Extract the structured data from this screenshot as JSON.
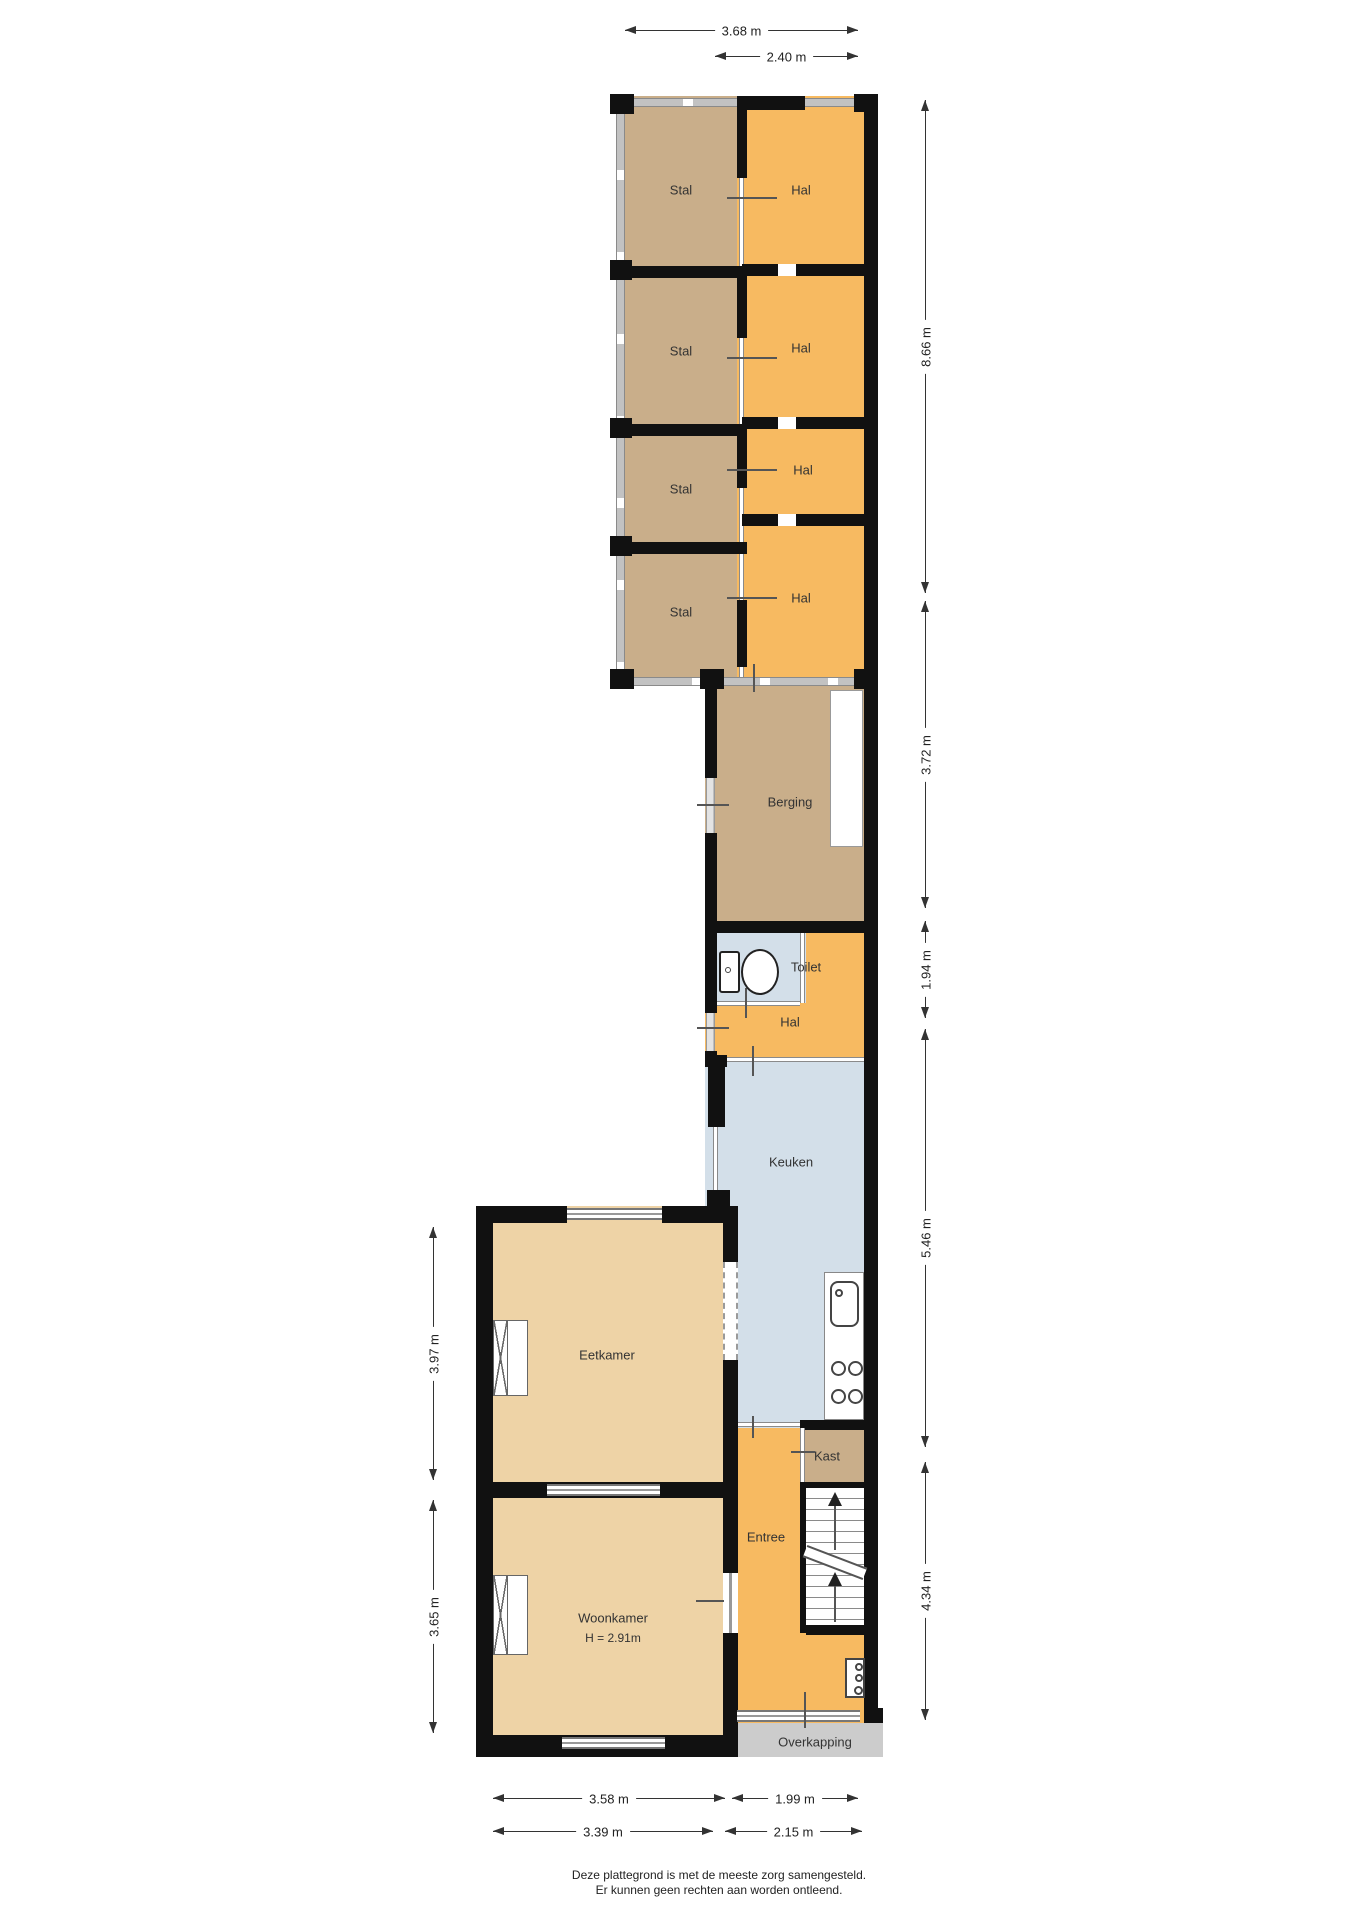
{
  "rooms": {
    "stal_1": "Stal",
    "stal_2": "Stal",
    "stal_3": "Stal",
    "stal_4": "Stal",
    "hal_1": "Hal",
    "hal_2": "Hal",
    "hal_3": "Hal",
    "hal_4": "Hal",
    "berging": "Berging",
    "toilet": "Toilet",
    "hal_middle": "Hal",
    "keuken": "Keuken",
    "eetkamer": "Eetkamer",
    "woonkamer": "Woonkamer",
    "woonkamer_ceiling_height": "H = 2.91m",
    "kast": "Kast",
    "entree": "Entree",
    "overkapping": "Overkapping"
  },
  "dimensions": {
    "top": [
      "3.68 m",
      "2.40 m"
    ],
    "right": [
      "8.66 m",
      "3.72 m",
      "1.94 m",
      "5.46 m",
      "4.34 m"
    ],
    "left": [
      "3.97 m",
      "3.65 m"
    ],
    "bottom_upper": [
      "3.58 m",
      "1.99 m"
    ],
    "bottom_lower": [
      "3.39 m",
      "2.15 m"
    ]
  },
  "footer": {
    "line1": "Deze plattegrond is met de meeste zorg samengesteld.",
    "line2": "Er kunnen geen rechten aan worden ontleend."
  },
  "colors": {
    "stable_tan": "#c9ae8a",
    "hall_orange": "#f7ba61",
    "wet_room_blue": "#d3dfe9",
    "living_beige": "#eed3a6",
    "canopy_gray": "#cccccc",
    "wall_black": "#111111",
    "light_wall_gray": "#c3c3c3"
  }
}
